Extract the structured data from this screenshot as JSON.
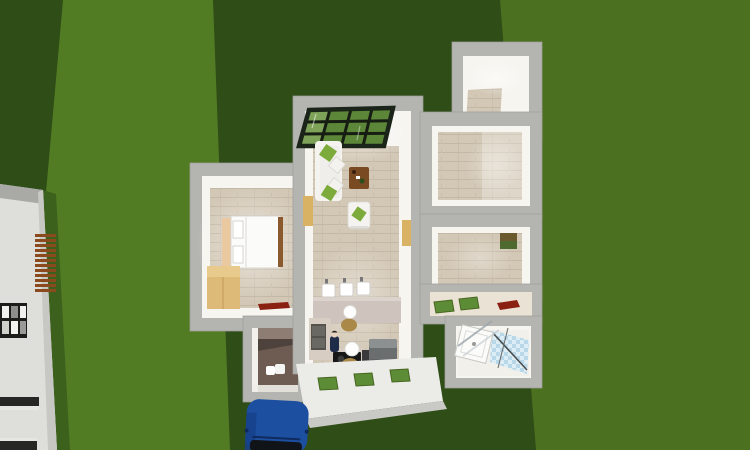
{
  "view": {
    "kind": "3d-home-design-aerial-view",
    "description": "Bird's-eye 3D rendering of a small flat on a green lawn, neighbouring building at left, blue car parked at the entrance"
  },
  "colors": {
    "grass_mid": "#4a7020",
    "grass_light": "#527c24",
    "grass_dark": "#2f4d16",
    "grass_shadow": "#3c611c",
    "building_white": "#dededa",
    "slat_brown": "#8a4a1e",
    "window_frame": "#1c1c1c",
    "wall_gray": "#b4b4b1",
    "wall_white": "#f7f5f0",
    "floor_wood": "#d3c8b6",
    "skylight_frame": "#1b2418",
    "skylight_glass": "#5d8738",
    "skylight_glass_light": "#8aab63",
    "sofa_white": "#f4f3ef",
    "cushion_green": "#7cab3c",
    "table_brown": "#7a4a22",
    "door_tan": "#d9b264",
    "bed_white": "#fbfbfa",
    "headboard_tan": "#eac9a0",
    "bed_frame": "#8a5a2e",
    "wardrobe_wood": "#ddba77",
    "counter_beige": "#d7cdc3",
    "vanity_pink": "#cfc3bd",
    "cooktop_black": "#171717",
    "fridge_gray": "#6b6e6f",
    "lamp_white": "#fdfdfd",
    "disc_tan": "#a98848",
    "darkbath_wall": "#4e423c",
    "darkbath_floor": "#6e5c52",
    "mat_green": "#5d8c36",
    "wedge_red": "#8a2012",
    "tile_blue": "#b8d7e8",
    "tile_blue_light": "#dcedf5",
    "terrace_white": "#ebebe8",
    "terrace_edge": "#c9c9c6",
    "car_blue": "#1d4fa1",
    "car_roof": "#101418",
    "toilet_white": "#ffffff",
    "person_navy": "#1e2c49"
  },
  "scene": {
    "ground": [
      "lawn",
      "dark hedge band",
      "building shadow"
    ],
    "neighbor_building": [
      "facade",
      "louver-shutter",
      "window-grid",
      "lower-windows"
    ],
    "rooms": [
      {
        "name": "bedroom",
        "furniture": [
          "double-bed",
          "wardrobe",
          "floor-runner"
        ]
      },
      {
        "name": "living-room",
        "furniture": [
          "glass-skylight",
          "sofa",
          "coffee-table",
          "armchair"
        ]
      },
      {
        "name": "washroom-corridor",
        "furniture": [
          "washbasin",
          "washbasin",
          "washbasin",
          "vanity-counter",
          "pendant-lamp"
        ]
      },
      {
        "name": "kitchen",
        "furniture": [
          "kitchen-counter",
          "cooktop",
          "refrigerator",
          "pendant-lamp",
          "person-figure"
        ]
      },
      {
        "name": "dark-bathroom",
        "furniture": [
          "toilet"
        ]
      },
      {
        "name": "storage-room",
        "furniture": []
      },
      {
        "name": "room-upper-right",
        "furniture": []
      },
      {
        "name": "room-lower-right",
        "furniture": [
          "wall-cabinet"
        ]
      },
      {
        "name": "hallway",
        "furniture": [
          "doormat",
          "doormat",
          "shoe-wedge"
        ]
      },
      {
        "name": "shower-bathroom",
        "furniture": [
          "shower-tray",
          "glass-panel",
          "tiled-wall"
        ]
      }
    ],
    "terrace": {
      "furniture": [
        "doormat",
        "doormat",
        "doormat"
      ]
    },
    "vehicles": [
      "blue-car"
    ]
  }
}
